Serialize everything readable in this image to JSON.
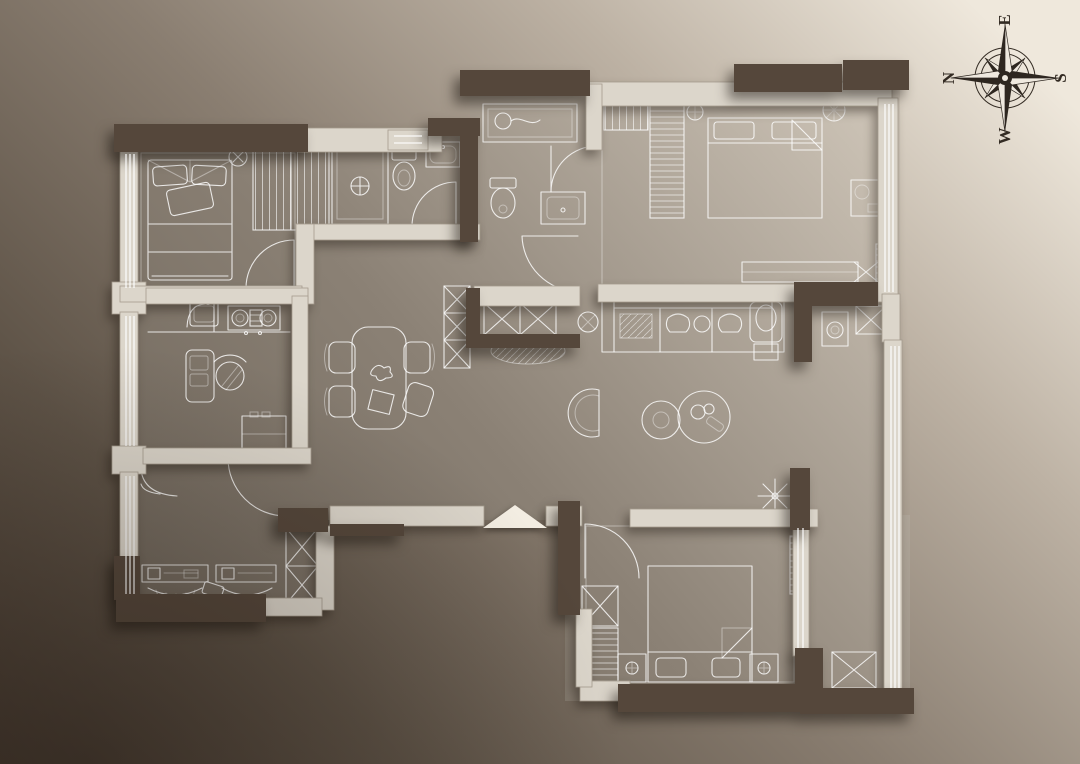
{
  "scene": {
    "type": "3d-floor-plan-render",
    "view": "top-down",
    "style": "monochrome sepia with white furniture line-work"
  },
  "compass": {
    "labels": {
      "top": "E",
      "left": "N",
      "right": "S",
      "bottom": "W"
    },
    "rotation_deg": -90
  },
  "palette": {
    "bg_dark": "#463a30",
    "bg_mid": "#8a7e71",
    "bg_light": "#efe8dc",
    "floor_dark": "#6b6257",
    "floor_mid": "#8b8175",
    "floor_light": "#d2c9bc",
    "wall_light": "#dcd6cb",
    "wall_edge": "#a59c8e",
    "wall_dark": "#55473b",
    "line_white": "#ffffff",
    "compass_ink": "#332b23"
  },
  "rooms": [
    {
      "id": "bedroom-top-left",
      "furniture": [
        "double-bed",
        "pillows",
        "wardrobe-hanging",
        "ceiling-lamp",
        "swing-door",
        "window-wall"
      ]
    },
    {
      "id": "bathroom-1",
      "furniture": [
        "shower-stall",
        "toilet",
        "washbasin",
        "swing-door",
        "small-window"
      ]
    },
    {
      "id": "bathroom-2",
      "furniture": [
        "shower-tray",
        "toilet",
        "washbasin",
        "swing-door"
      ]
    },
    {
      "id": "master-bedroom",
      "furniture": [
        "double-bed",
        "folded-blanket-corner",
        "wardrobe-hanging",
        "desk",
        "plant",
        "tv-cabinet",
        "ac-unit",
        "window-wall"
      ]
    },
    {
      "id": "kitchen-study",
      "furniture": [
        "counter",
        "sink",
        "cooktop-2-burner",
        "desk",
        "office-chair",
        "refrigerator",
        "sliding-door"
      ]
    },
    {
      "id": "dining",
      "furniture": [
        "dining-table",
        "chair-x4",
        "flower-centerpiece",
        "placemat"
      ]
    },
    {
      "id": "hall-cabinets",
      "furniture": [
        "x-storage-cabinets",
        "rug",
        "plant",
        "hall-door"
      ]
    },
    {
      "id": "living",
      "furniture": [
        "sofa",
        "seat-cushions",
        "round-pillow",
        "armchair",
        "ottoman",
        "coffee-table-x2",
        "lounge-chair"
      ]
    },
    {
      "id": "bottom-left-room",
      "furniture": [
        "workstation-desk-x2",
        "monitors",
        "keyboard-arcs",
        "x-storage-column",
        "corner-counter",
        "swing-door",
        "window-wall"
      ]
    },
    {
      "id": "bedroom-bottom",
      "furniture": [
        "double-bed",
        "pillows",
        "nightstand-x2",
        "lamps",
        "wardrobe",
        "plant-snowflake",
        "swing-door",
        "window-wall"
      ]
    },
    {
      "id": "balcony-right",
      "furniture": [
        "sliding-window-wall",
        "radiator",
        "washer",
        "x-storage-cabinet"
      ]
    }
  ],
  "entry": {
    "marker": "entry-wedge"
  }
}
